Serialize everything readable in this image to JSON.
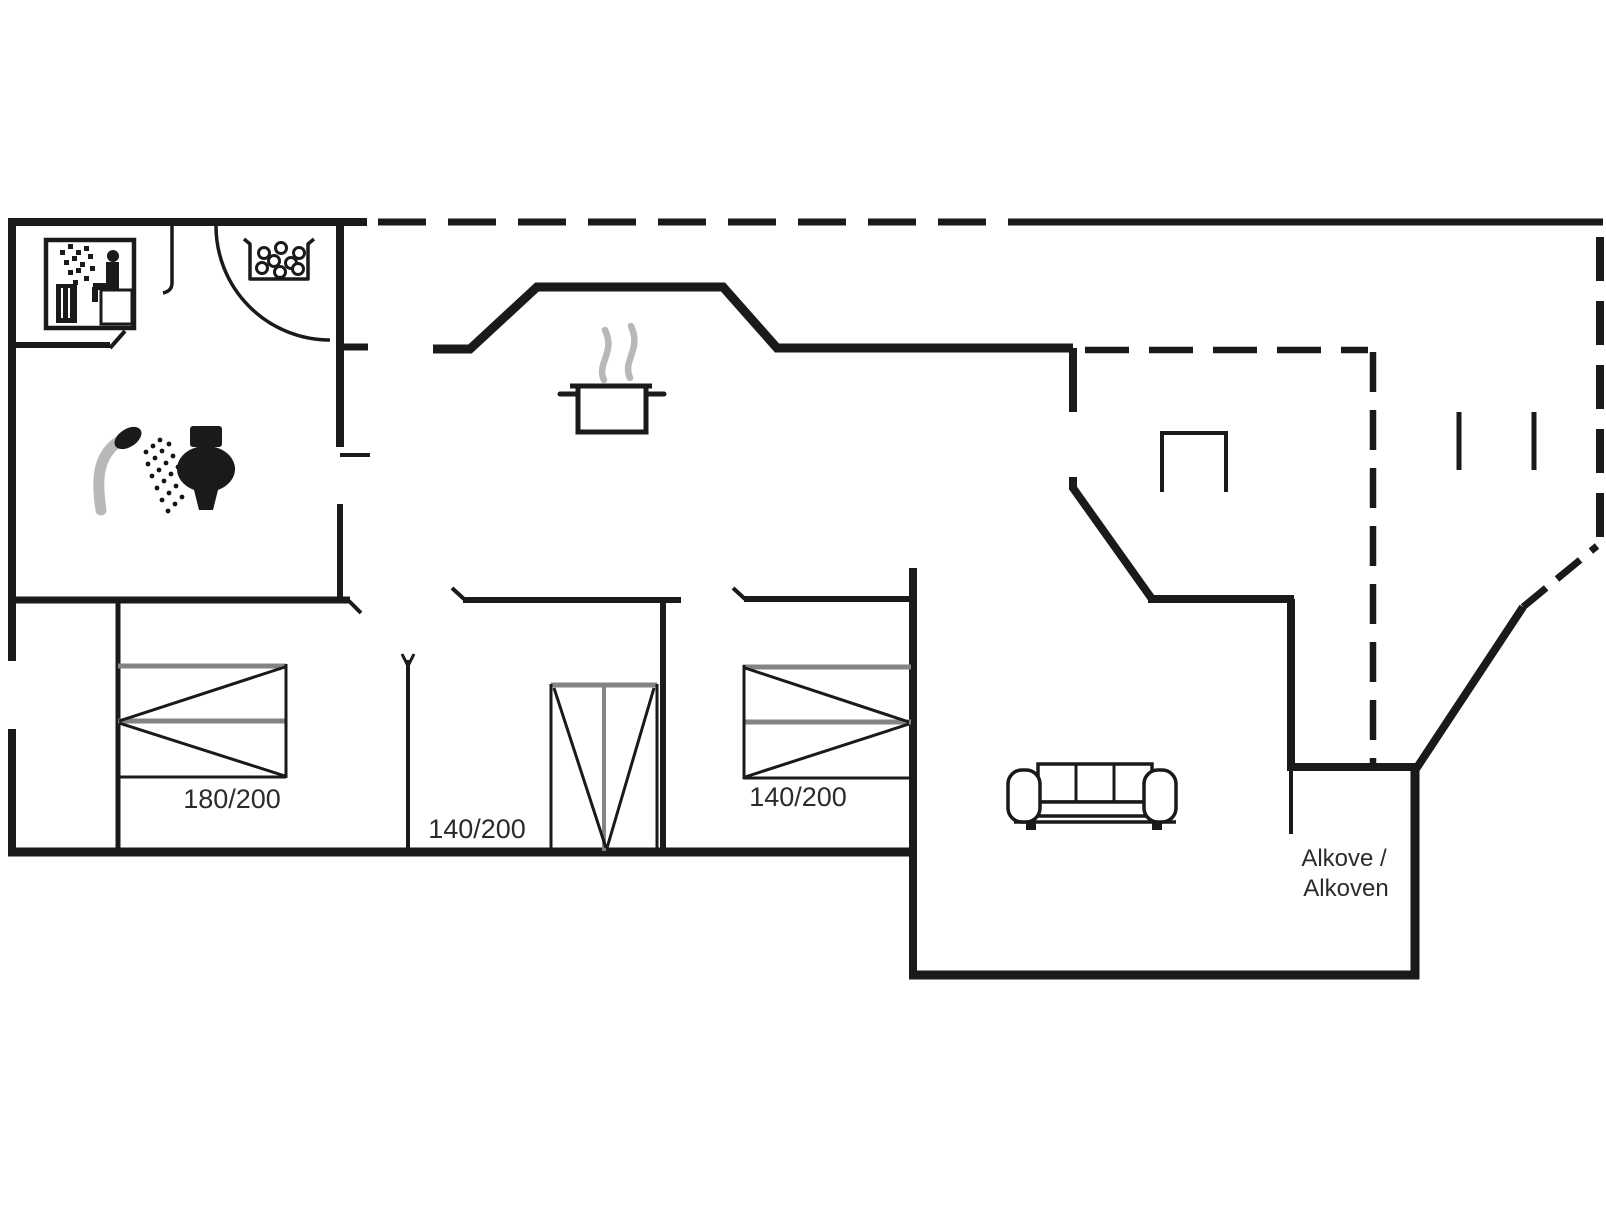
{
  "plan": {
    "type": "holiday-house-floor-plan",
    "labels": {
      "bed_double": "180/200",
      "bed_middle": "140/200",
      "bed_right": "140/200",
      "alcove_line1": "Alkove /",
      "alcove_line2": "Alkoven"
    },
    "icons": [
      "sauna-icon",
      "whirlpool-stones-icon",
      "entrance-door-arc",
      "shower-icon",
      "toilet-icon",
      "cooking-pot-icon",
      "bed-icon",
      "sofa-icon",
      "terrace-table",
      "terrace-posts",
      "roof-overhang-dashed-line"
    ],
    "colors": {
      "wall": "#1a1a1a",
      "gray_accent": "#848484",
      "steam_gray": "#b8b8b8",
      "text": "#2b2b2b",
      "background": "#ffffff"
    }
  }
}
